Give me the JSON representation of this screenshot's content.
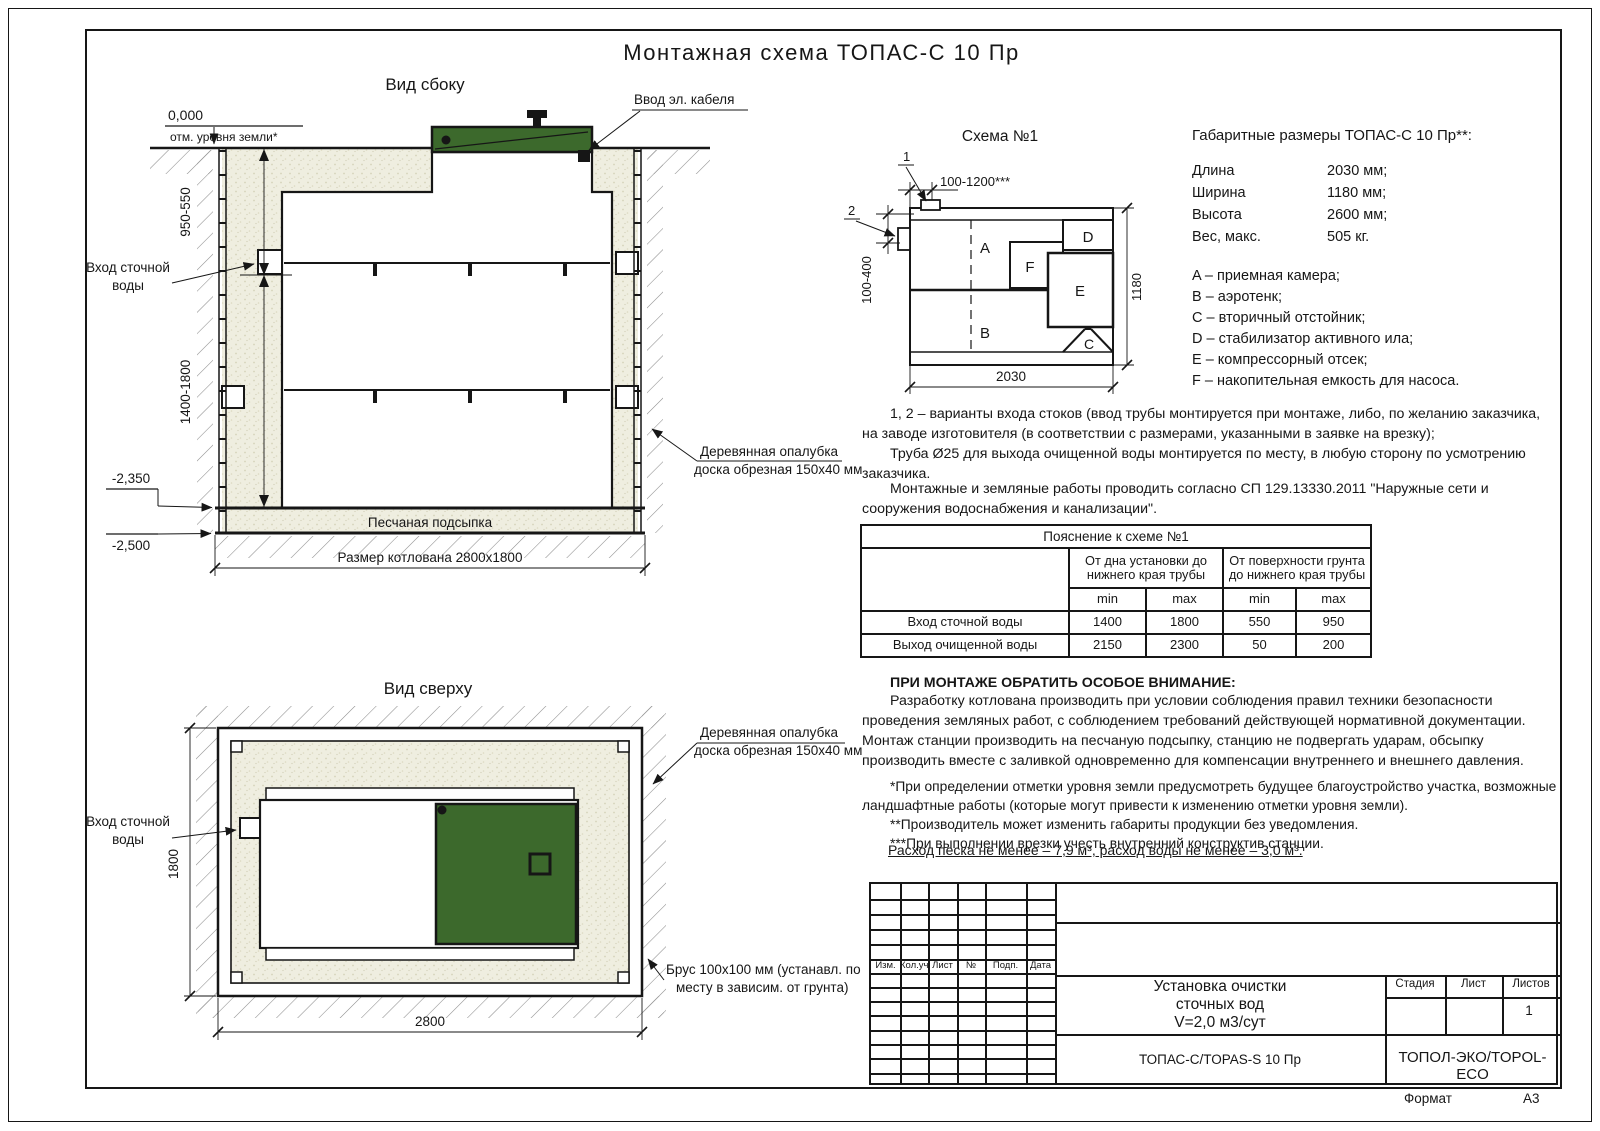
{
  "page": {
    "title": "Монтажная схема ТОПАС-С 10 Пр",
    "format_label": "Формат",
    "format_value": "А3"
  },
  "colors": {
    "green": "#3c692c",
    "sand_base": "#efeee0",
    "line": "#161616"
  },
  "side_view": {
    "title": "Вид сбоку",
    "zero_mark": "0,000",
    "ground_note": "отм. уровня земли*",
    "dim_depth_top": "950-550",
    "dim_depth_bottom": "1400-1800",
    "inlet_line1": "Вход сточной",
    "inlet_line2": "воды",
    "cable_label": "Ввод эл. кабеля",
    "elev_tank_bottom": "-2,350",
    "elev_pit_bottom": "-2,500",
    "sand_label": "Песчаная подсыпка",
    "pit_dim": "Размер котлована 2800х1800",
    "formwork_line1": "Деревянная опалубка",
    "formwork_line2": "доска обрезная 150х40 мм"
  },
  "top_view": {
    "title": "Вид сверху",
    "inlet_line1": "Вход сточной",
    "inlet_line2": "воды",
    "dim_height": "1800",
    "dim_width": "2800",
    "formwork_line1": "Деревянная опалубка",
    "formwork_line2": "доска обрезная 150х40 мм",
    "beam_line1": "Брус 100х100 мм (устанавл. по",
    "beam_line2": "месту в зависим. от грунта)"
  },
  "schema": {
    "title": "Схема №1",
    "callout_1": "1",
    "callout_2": "2",
    "dim_top": "100-1200***",
    "dim_left": "100-400",
    "dim_bottom": "2030",
    "dim_right": "1180",
    "comp_a": "A",
    "comp_b": "B",
    "comp_c": "C",
    "comp_d": "D",
    "comp_e": "E",
    "comp_f": "F"
  },
  "specs": {
    "title": "Габаритные размеры ТОПАС-С 10 Пр**:",
    "rows": [
      {
        "label": "Длина",
        "value": "2030 мм;"
      },
      {
        "label": "Ширина",
        "value": "1180 мм;"
      },
      {
        "label": "Высота",
        "value": "2600 мм;"
      },
      {
        "label": "Вес, макс.",
        "value": "505 кг."
      }
    ],
    "legend": [
      "A – приемная камера;",
      "B – аэротенк;",
      "C – вторичный отстойник;",
      "D – стабилизатор активного ила;",
      "E – компрессорный отсек;",
      "F – накопительная емкость для насоса."
    ]
  },
  "notes": {
    "variants_1": "1, 2 – варианты входа  стоков (ввод трубы монтируется при монтаже, либо, по желанию заказчика, на заводе изготовителя (в соответствии с размерами, указанными в заявке на врезку);",
    "variants_2": "Труба Ø25 для выхода очищенной воды монтируется по месту, в любую сторону по усмотрению заказчика.",
    "works": "Монтажные и земляные работы проводить согласно СП 129.13330.2011 \"Наружные сети и сооружения водоснабжения и канализации\".",
    "attention_title": "ПРИ МОНТАЖЕ ОБРАТИТЬ ОСОБОЕ ВНИМАНИЕ:",
    "attention_body": "Разработку котлована производить при условии соблюдения правил техники безопасности проведения земляных работ, с соблюдением требований действующей нормативной документации. Монтаж станции производить на песчаную подсыпку, станцию не подвергать ударам, обсыпку производить вместе с заливкой одновременно для компенсации внутреннего и внешнего давления.",
    "footnote_1": "*При определении отметки уровня земли предусмотреть будущее благоустройство участка, возможные ландшафтные работы (которые могут привести к изменению отметки уровня земли).",
    "footnote_2": "**Производитель может изменить габариты продукции без уведомления.",
    "footnote_3": "***При выполнении врезки учесть внутренний конструктив станции.",
    "consumption": "Расход песка не менее – 7,9 м³, расход воды не менее – 3,0 м³."
  },
  "explain_table": {
    "title": "Пояснение к схеме №1",
    "col_bottom": "От дна установки до нижнего края трубы",
    "col_surface": "От поверхности грунта до нижнего края трубы",
    "min": "min",
    "max": "max",
    "rows": [
      {
        "name": "Вход сточной воды",
        "v1": "1400",
        "v2": "1800",
        "v3": "550",
        "v4": "950"
      },
      {
        "name": "Выход очищенной воды",
        "v1": "2150",
        "v2": "2300",
        "v3": "50",
        "v4": "200"
      }
    ]
  },
  "stamp": {
    "cols": [
      "Изм.",
      "Кол.уч.",
      "Лист",
      "№ док.",
      "Подп.",
      "Дата"
    ],
    "doc_title_1": "Установка очистки",
    "doc_title_2": "сточных вод",
    "doc_title_3": "V=2,0 м3/сут",
    "stage": "Стадия",
    "sheet": "Лист",
    "sheets": "Листов",
    "sheets_value": "1",
    "model": "ТОПАС-С/TOPAS-S 10 Пр",
    "company": "ТОПОЛ-ЭКО/TOPOL-ECO"
  }
}
